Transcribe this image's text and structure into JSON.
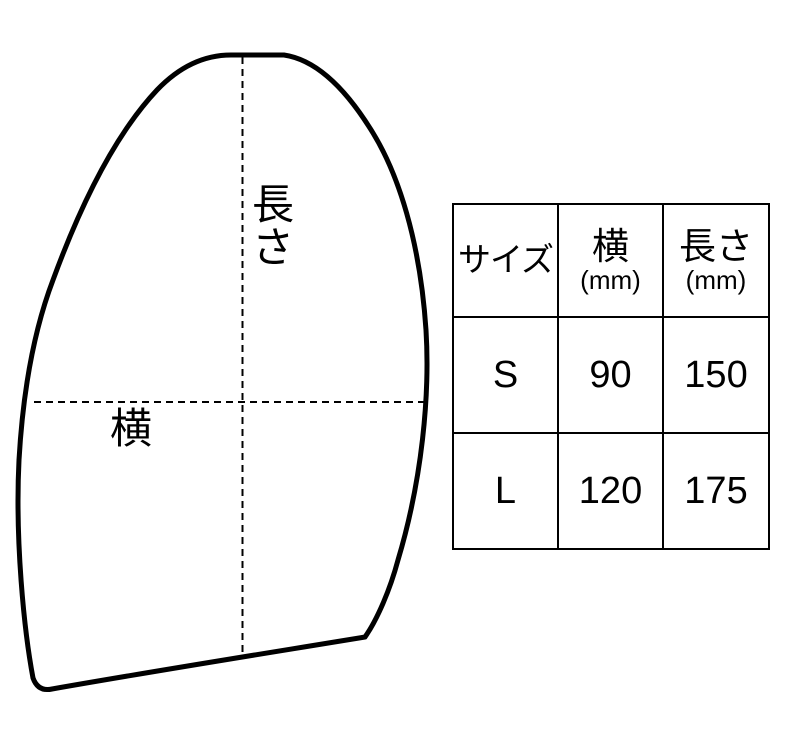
{
  "diagram": {
    "length_label": "長さ",
    "width_label": "横"
  },
  "size_table": {
    "columns": [
      {
        "title": "サイズ",
        "unit": ""
      },
      {
        "title": "横",
        "unit": "(mm)"
      },
      {
        "title": "長さ",
        "unit": "(mm)"
      }
    ],
    "rows": [
      {
        "size": "S",
        "width_mm": "90",
        "length_mm": "150"
      },
      {
        "size": "L",
        "width_mm": "120",
        "length_mm": "175"
      }
    ]
  },
  "colors": {
    "line": "#000000",
    "background": "#ffffff",
    "text": "#000000"
  }
}
